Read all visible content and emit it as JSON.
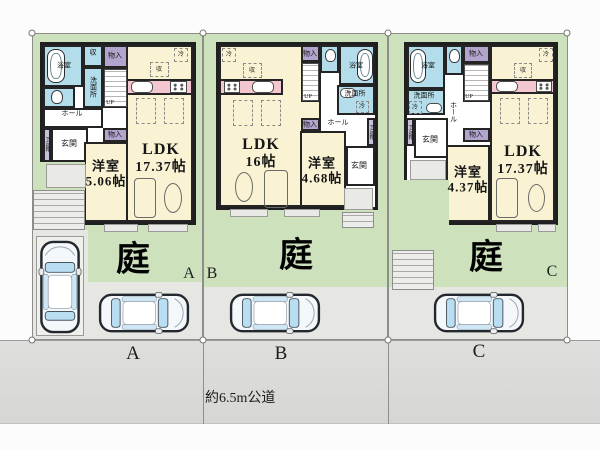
{
  "page": {
    "width": 600,
    "height": 450,
    "bg": "#fcfcfc"
  },
  "colors": {
    "green": "#cde1bd",
    "road": "#dcdcda",
    "drive": "#e6e6e3",
    "wall": "#1f1f1f",
    "cream": "#faf3d3",
    "blue": "#b3ddeb",
    "purple": "#b2a4cc",
    "purpleLight": "#c9c0de",
    "pink": "#f3c6d0",
    "white": "#ffffff",
    "carWindow": "#b9ddf1",
    "carBody": "#f4f8fb",
    "carOutline": "#23282e"
  },
  "road": {
    "label": "約6.5m公道",
    "y": 340,
    "h": 84,
    "letters": [
      {
        "t": "A",
        "x": 133,
        "y": 354,
        "s": 19
      },
      {
        "t": "B",
        "x": 281,
        "y": 354,
        "s": 19
      },
      {
        "t": "C",
        "x": 479,
        "y": 352,
        "s": 19
      }
    ],
    "lines": [
      203,
      388
    ]
  },
  "parcels": [
    {
      "id": "A",
      "x": 32,
      "y": 33,
      "w": 171,
      "h": 307,
      "garden": {
        "t": "庭",
        "x": 133,
        "y": 256,
        "s": 34
      },
      "letter": {
        "t": "A",
        "x": 189,
        "y": 274,
        "s": 16
      },
      "drives": [
        {
          "x": 33,
          "y": 230,
          "w": 55,
          "h": 109
        },
        {
          "x": 33,
          "y": 282,
          "w": 169,
          "h": 57
        }
      ],
      "parking": {
        "x": 36,
        "y": 236,
        "w": 48,
        "h": 100
      }
    },
    {
      "id": "B",
      "x": 203,
      "y": 33,
      "w": 185,
      "h": 307,
      "garden": {
        "t": "庭",
        "x": 296,
        "y": 252,
        "s": 34
      },
      "letter": {
        "t": "B",
        "x": 212,
        "y": 274,
        "s": 16
      },
      "drives": [
        {
          "x": 204,
          "y": 287,
          "w": 183,
          "h": 52
        }
      ]
    },
    {
      "id": "C",
      "x": 388,
      "y": 33,
      "w": 180,
      "h": 307,
      "garden": {
        "t": "庭",
        "x": 486,
        "y": 254,
        "s": 34
      },
      "letter": {
        "t": "C",
        "x": 552,
        "y": 272,
        "s": 16
      },
      "drives": [
        {
          "x": 389,
          "y": 287,
          "w": 178,
          "h": 52
        }
      ]
    }
  ],
  "houses": [
    {
      "id": "A",
      "frame": {
        "x": 40,
        "y": 42,
        "w": 156,
        "h": 183
      },
      "cutouts": [
        {
          "x": 37,
          "y": 162,
          "w": 48,
          "h": 66
        }
      ],
      "rooms": [
        {
          "n": "ldk",
          "x": 126,
          "y": 45,
          "w": 67,
          "h": 177,
          "c": "cream"
        },
        {
          "n": "kitchen",
          "x": 126,
          "y": 79,
          "w": 67,
          "h": 16,
          "c": "pink"
        },
        {
          "n": "bathroom",
          "x": 43,
          "y": 45,
          "w": 40,
          "h": 42,
          "c": "blue"
        },
        {
          "n": "storage-shu",
          "x": 83,
          "y": 45,
          "w": 20,
          "h": 22,
          "c": "blue"
        },
        {
          "n": "washroom",
          "x": 83,
          "y": 67,
          "w": 20,
          "h": 41,
          "c": "blue"
        },
        {
          "n": "closet-top",
          "x": 103,
          "y": 45,
          "w": 25,
          "h": 23,
          "c": "purple"
        },
        {
          "n": "stairwell",
          "x": 103,
          "y": 68,
          "w": 25,
          "h": 40,
          "c": "white"
        },
        {
          "n": "toilet-room",
          "x": 43,
          "y": 87,
          "w": 32,
          "h": 21,
          "c": "blue"
        },
        {
          "n": "hall",
          "x": 43,
          "y": 108,
          "w": 60,
          "h": 20,
          "c": "white"
        },
        {
          "n": "shoe-box",
          "x": 43,
          "y": 128,
          "w": 8,
          "h": 34,
          "c": "purpleLight"
        },
        {
          "n": "entrance",
          "x": 51,
          "y": 128,
          "w": 37,
          "h": 34,
          "c": "white"
        },
        {
          "n": "closet-mid",
          "x": 103,
          "y": 128,
          "w": 25,
          "h": 14,
          "c": "purple"
        },
        {
          "n": "bedroom",
          "x": 84,
          "y": 142,
          "w": 44,
          "h": 80,
          "c": "cream"
        }
      ],
      "fixtures": [
        {
          "t": "stairs",
          "x": 104,
          "y": 69,
          "w": 23,
          "h": 38
        },
        {
          "t": "tub",
          "x": 47,
          "y": 49,
          "w": 18,
          "h": 34
        },
        {
          "t": "toilet",
          "x": 51,
          "y": 90,
          "w": 12,
          "h": 14
        },
        {
          "t": "sink",
          "x": 131,
          "y": 81,
          "w": 22,
          "h": 12
        },
        {
          "t": "stove",
          "x": 170,
          "y": 81,
          "w": 17,
          "h": 12
        },
        {
          "t": "dash",
          "x": 174,
          "y": 48,
          "w": 14,
          "h": 14
        },
        {
          "t": "dash",
          "x": 150,
          "y": 62,
          "w": 19,
          "h": 15
        },
        {
          "t": "dash",
          "x": 136,
          "y": 98,
          "w": 20,
          "h": 26
        },
        {
          "t": "dash",
          "x": 164,
          "y": 98,
          "w": 20,
          "h": 26
        },
        {
          "t": "sofa",
          "x": 134,
          "y": 178,
          "w": 22,
          "h": 40
        },
        {
          "t": "oval",
          "x": 164,
          "y": 183,
          "w": 18,
          "h": 30
        },
        {
          "t": "porch",
          "x": 46,
          "y": 164,
          "w": 40,
          "h": 24
        },
        {
          "t": "extstairs",
          "x": 33,
          "y": 190,
          "w": 52,
          "h": 40
        },
        {
          "t": "porch",
          "x": 104,
          "y": 224,
          "w": 34,
          "h": 8
        },
        {
          "t": "porch",
          "x": 148,
          "y": 224,
          "w": 40,
          "h": 8
        }
      ],
      "labels": [
        {
          "t": "浴室",
          "x": 64,
          "y": 66,
          "s": 7
        },
        {
          "t": "収",
          "x": 93,
          "y": 53,
          "s": 7
        },
        {
          "t": "洗面所",
          "x": 93,
          "y": 87,
          "s": 7,
          "v": true
        },
        {
          "t": "物入",
          "x": 115,
          "y": 56,
          "s": 7
        },
        {
          "t": "UP",
          "x": 110,
          "y": 103,
          "s": 6
        },
        {
          "t": "ホール",
          "x": 72,
          "y": 114,
          "s": 7
        },
        {
          "t": "玄関",
          "x": 69,
          "y": 144,
          "s": 8
        },
        {
          "t": "下足箱",
          "x": 47,
          "y": 144,
          "s": 5,
          "v": true
        },
        {
          "t": "物入",
          "x": 115,
          "y": 135,
          "s": 7
        },
        {
          "t": "洋室",
          "x": 106,
          "y": 166,
          "s": 13
        },
        {
          "t": "5.06帖",
          "x": 106,
          "y": 181,
          "s": 13
        },
        {
          "t": "LDK",
          "x": 161,
          "y": 150,
          "s": 16
        },
        {
          "t": "17.37帖",
          "x": 161,
          "y": 168,
          "s": 14
        },
        {
          "t": "冷",
          "x": 181,
          "y": 55,
          "s": 6
        },
        {
          "t": "収",
          "x": 159,
          "y": 70,
          "s": 6
        }
      ]
    },
    {
      "id": "B",
      "frame": {
        "x": 216,
        "y": 42,
        "w": 162,
        "h": 168
      },
      "cutouts": [],
      "rooms": [
        {
          "n": "ldk",
          "x": 219,
          "y": 45,
          "w": 102,
          "h": 162,
          "c": "cream"
        },
        {
          "n": "kitchen",
          "x": 219,
          "y": 79,
          "w": 64,
          "h": 16,
          "c": "pink"
        },
        {
          "n": "closet-top",
          "x": 301,
          "y": 45,
          "w": 19,
          "h": 17,
          "c": "purple"
        },
        {
          "n": "stairwell",
          "x": 301,
          "y": 62,
          "w": 19,
          "h": 40,
          "c": "white"
        },
        {
          "n": "toilet-room",
          "x": 320,
          "y": 45,
          "w": 19,
          "h": 28,
          "c": "blue"
        },
        {
          "n": "bathroom",
          "x": 339,
          "y": 45,
          "w": 36,
          "h": 40,
          "c": "blue"
        },
        {
          "n": "washroom",
          "x": 337,
          "y": 85,
          "w": 38,
          "h": 30,
          "c": "blue"
        },
        {
          "n": "closet-mid",
          "x": 301,
          "y": 118,
          "w": 19,
          "h": 13,
          "c": "purple"
        },
        {
          "n": "shoe-box",
          "x": 367,
          "y": 118,
          "w": 8,
          "h": 28,
          "c": "purpleLight"
        },
        {
          "n": "entrance",
          "x": 346,
          "y": 146,
          "w": 29,
          "h": 40,
          "c": "white"
        },
        {
          "n": "bedroom",
          "x": 300,
          "y": 131,
          "w": 46,
          "h": 76,
          "c": "cream"
        }
      ],
      "fixtures": [
        {
          "t": "stairs",
          "x": 302,
          "y": 63,
          "w": 17,
          "h": 38
        },
        {
          "t": "tub",
          "x": 357,
          "y": 49,
          "w": 16,
          "h": 32
        },
        {
          "t": "toilet",
          "x": 325,
          "y": 49,
          "w": 11,
          "h": 13
        },
        {
          "t": "sink",
          "x": 340,
          "y": 88,
          "w": 16,
          "h": 10
        },
        {
          "t": "dash",
          "x": 356,
          "y": 101,
          "w": 13,
          "h": 12
        },
        {
          "t": "sink",
          "x": 252,
          "y": 81,
          "w": 22,
          "h": 12
        },
        {
          "t": "stove",
          "x": 224,
          "y": 81,
          "w": 16,
          "h": 12
        },
        {
          "t": "dash",
          "x": 222,
          "y": 48,
          "w": 14,
          "h": 14
        },
        {
          "t": "dash",
          "x": 243,
          "y": 63,
          "w": 19,
          "h": 15
        },
        {
          "t": "dash",
          "x": 233,
          "y": 100,
          "w": 20,
          "h": 26
        },
        {
          "t": "dash",
          "x": 261,
          "y": 100,
          "w": 20,
          "h": 26
        },
        {
          "t": "oval",
          "x": 235,
          "y": 172,
          "w": 18,
          "h": 30
        },
        {
          "t": "sofa",
          "x": 264,
          "y": 170,
          "w": 24,
          "h": 38
        },
        {
          "t": "porch",
          "x": 344,
          "y": 188,
          "w": 29,
          "h": 22
        },
        {
          "t": "extstairs",
          "x": 342,
          "y": 212,
          "w": 32,
          "h": 16
        },
        {
          "t": "porch",
          "x": 230,
          "y": 209,
          "w": 38,
          "h": 8
        },
        {
          "t": "porch",
          "x": 284,
          "y": 209,
          "w": 36,
          "h": 8
        }
      ],
      "labels": [
        {
          "t": "冷",
          "x": 229,
          "y": 55,
          "s": 6
        },
        {
          "t": "収",
          "x": 252,
          "y": 71,
          "s": 6
        },
        {
          "t": "物入",
          "x": 310,
          "y": 54,
          "s": 7
        },
        {
          "t": "UP",
          "x": 308,
          "y": 97,
          "s": 6
        },
        {
          "t": "浴室",
          "x": 356,
          "y": 66,
          "s": 7
        },
        {
          "t": "洗面所",
          "x": 355,
          "y": 94,
          "s": 7
        },
        {
          "t": "冷",
          "x": 362,
          "y": 107,
          "s": 6
        },
        {
          "t": "物入",
          "x": 310,
          "y": 125,
          "s": 7
        },
        {
          "t": "ホール",
          "x": 338,
          "y": 123,
          "s": 7
        },
        {
          "t": "下足箱",
          "x": 371,
          "y": 132,
          "s": 5,
          "v": true
        },
        {
          "t": "玄関",
          "x": 359,
          "y": 166,
          "s": 8
        },
        {
          "t": "洋室",
          "x": 322,
          "y": 163,
          "s": 13
        },
        {
          "t": "4.68帖",
          "x": 322,
          "y": 178,
          "s": 13
        },
        {
          "t": "LDK",
          "x": 261,
          "y": 145,
          "s": 16
        },
        {
          "t": "16帖",
          "x": 261,
          "y": 163,
          "s": 14
        }
      ]
    },
    {
      "id": "C",
      "frame": {
        "x": 404,
        "y": 42,
        "w": 154,
        "h": 183
      },
      "cutouts": [
        {
          "x": 401,
          "y": 180,
          "w": 48,
          "h": 48
        }
      ],
      "rooms": [
        {
          "n": "ldk",
          "x": 490,
          "y": 45,
          "w": 65,
          "h": 177,
          "c": "cream"
        },
        {
          "n": "kitchen",
          "x": 490,
          "y": 79,
          "w": 65,
          "h": 15,
          "c": "pink"
        },
        {
          "n": "bathroom",
          "x": 407,
          "y": 45,
          "w": 38,
          "h": 44,
          "c": "blue"
        },
        {
          "n": "toilet-room",
          "x": 445,
          "y": 45,
          "w": 18,
          "h": 30,
          "c": "blue"
        },
        {
          "n": "closet-top",
          "x": 463,
          "y": 45,
          "w": 27,
          "h": 18,
          "c": "purple"
        },
        {
          "n": "stairwell",
          "x": 463,
          "y": 63,
          "w": 27,
          "h": 39,
          "c": "white"
        },
        {
          "n": "washroom",
          "x": 407,
          "y": 89,
          "w": 38,
          "h": 26,
          "c": "blue"
        },
        {
          "n": "shoe-box",
          "x": 406,
          "y": 118,
          "w": 8,
          "h": 28,
          "c": "purpleLight"
        },
        {
          "n": "entrance",
          "x": 414,
          "y": 118,
          "w": 34,
          "h": 40,
          "c": "white"
        },
        {
          "n": "closet-mid",
          "x": 463,
          "y": 128,
          "w": 27,
          "h": 14,
          "c": "purple"
        },
        {
          "n": "bedroom",
          "x": 446,
          "y": 145,
          "w": 44,
          "h": 77,
          "c": "cream"
        }
      ],
      "fixtures": [
        {
          "t": "stairs",
          "x": 464,
          "y": 64,
          "w": 25,
          "h": 37
        },
        {
          "t": "tub",
          "x": 410,
          "y": 49,
          "w": 16,
          "h": 34
        },
        {
          "t": "toilet",
          "x": 449,
          "y": 49,
          "w": 11,
          "h": 14
        },
        {
          "t": "sink",
          "x": 426,
          "y": 103,
          "w": 16,
          "h": 10
        },
        {
          "t": "dash",
          "x": 409,
          "y": 101,
          "w": 13,
          "h": 13
        },
        {
          "t": "sink",
          "x": 496,
          "y": 81,
          "w": 22,
          "h": 11
        },
        {
          "t": "stove",
          "x": 536,
          "y": 81,
          "w": 16,
          "h": 11
        },
        {
          "t": "dash",
          "x": 539,
          "y": 48,
          "w": 14,
          "h": 14
        },
        {
          "t": "dash",
          "x": 514,
          "y": 63,
          "w": 18,
          "h": 15
        },
        {
          "t": "dash",
          "x": 500,
          "y": 98,
          "w": 20,
          "h": 26
        },
        {
          "t": "dash",
          "x": 528,
          "y": 98,
          "w": 20,
          "h": 26
        },
        {
          "t": "sofa",
          "x": 496,
          "y": 178,
          "w": 22,
          "h": 40
        },
        {
          "t": "oval",
          "x": 528,
          "y": 184,
          "w": 17,
          "h": 28
        },
        {
          "t": "porch",
          "x": 410,
          "y": 160,
          "w": 36,
          "h": 20
        },
        {
          "t": "extstairs",
          "x": 392,
          "y": 250,
          "w": 42,
          "h": 40
        },
        {
          "t": "porch",
          "x": 496,
          "y": 224,
          "w": 36,
          "h": 8
        },
        {
          "t": "porch",
          "x": 538,
          "y": 224,
          "w": 18,
          "h": 8
        }
      ],
      "labels": [
        {
          "t": "浴室",
          "x": 428,
          "y": 66,
          "s": 7
        },
        {
          "t": "物入",
          "x": 476,
          "y": 54,
          "s": 7
        },
        {
          "t": "UP",
          "x": 469,
          "y": 97,
          "s": 6
        },
        {
          "t": "洗面所",
          "x": 424,
          "y": 96,
          "s": 7
        },
        {
          "t": "冷",
          "x": 415,
          "y": 108,
          "s": 6
        },
        {
          "t": "ホール",
          "x": 453,
          "y": 112,
          "s": 7,
          "v": true
        },
        {
          "t": "玄関",
          "x": 430,
          "y": 140,
          "s": 8
        },
        {
          "t": "下足箱",
          "x": 410,
          "y": 132,
          "s": 5,
          "v": true
        },
        {
          "t": "物入",
          "x": 476,
          "y": 135,
          "s": 7
        },
        {
          "t": "洋室",
          "x": 468,
          "y": 172,
          "s": 13
        },
        {
          "t": "4.37帖",
          "x": 468,
          "y": 187,
          "s": 13
        },
        {
          "t": "LDK",
          "x": 523,
          "y": 152,
          "s": 16
        },
        {
          "t": "17.37帖",
          "x": 523,
          "y": 170,
          "s": 14
        },
        {
          "t": "冷",
          "x": 546,
          "y": 55,
          "s": 6
        },
        {
          "t": "収",
          "x": 523,
          "y": 71,
          "s": 6
        }
      ]
    }
  ],
  "cars": [
    {
      "x": 13,
      "y": 265,
      "w": 94,
      "h": 44,
      "rot": -90
    },
    {
      "x": 97,
      "y": 292,
      "w": 94,
      "h": 42,
      "rot": 0
    },
    {
      "x": 228,
      "y": 292,
      "w": 94,
      "h": 42,
      "rot": 0
    },
    {
      "x": 432,
      "y": 292,
      "w": 94,
      "h": 42,
      "rot": 0
    }
  ],
  "markers": [
    [
      32,
      33
    ],
    [
      203,
      33
    ],
    [
      388,
      33
    ],
    [
      567,
      33
    ],
    [
      32,
      340
    ],
    [
      203,
      340
    ],
    [
      388,
      340
    ],
    [
      567,
      340
    ]
  ]
}
